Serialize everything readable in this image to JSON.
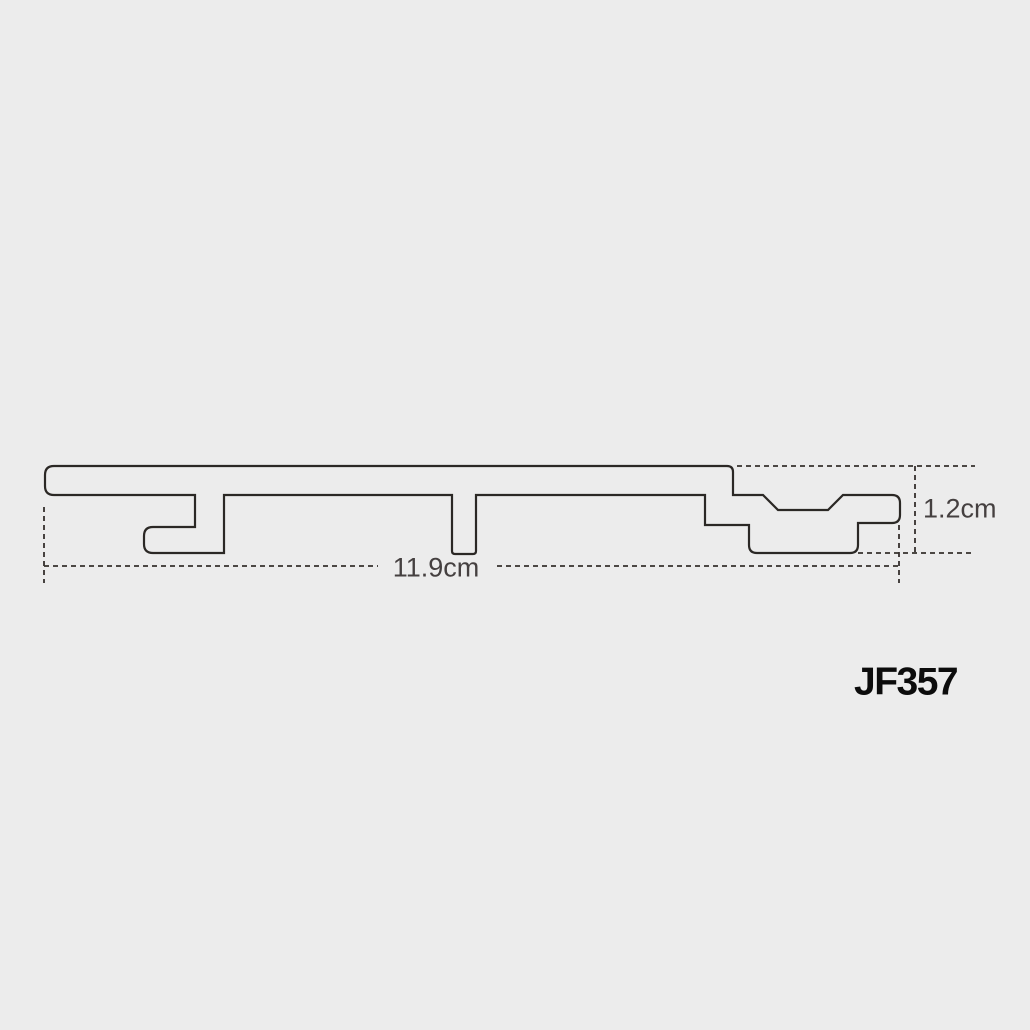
{
  "page": {
    "background_color": "#ececec"
  },
  "diagram": {
    "kind": "panel-profile-cross-section",
    "outline_color": "#2b2825",
    "dimension_line_color": "#35302d",
    "dimension_label_color": "#454040",
    "product_code_color": "#0c0c0c",
    "width_dimension": {
      "value": "11.9cm"
    },
    "height_dimension": {
      "value": "1.2cm"
    },
    "product_code": "JF357"
  }
}
